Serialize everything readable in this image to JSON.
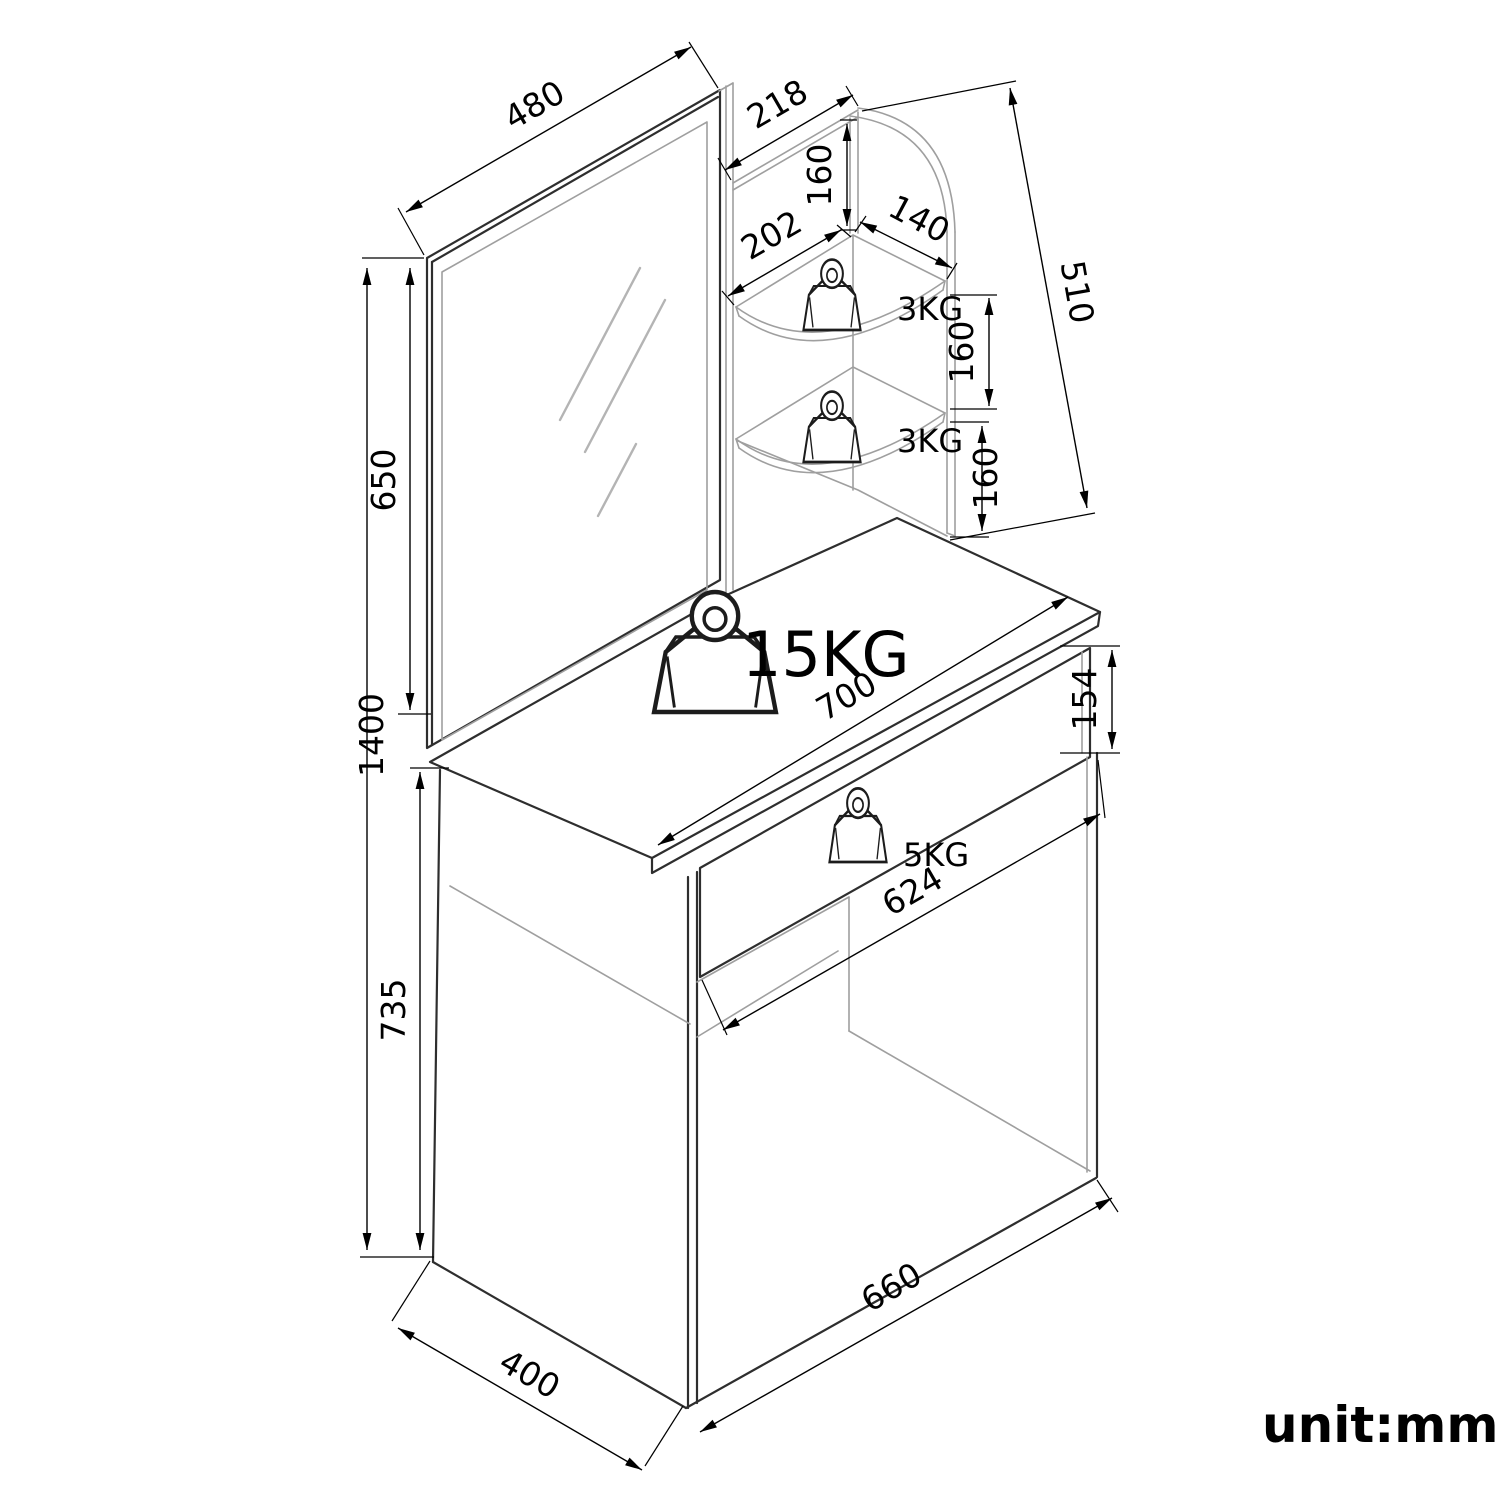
{
  "drawing": {
    "unit_label": "unit:mm",
    "capacities": {
      "tabletop": "15KG",
      "drawer": "5KG",
      "upper_shelf": "3KG",
      "lower_shelf": "3KG"
    },
    "dimensions": {
      "mirror_width": "480",
      "mirror_height": "650",
      "top_shelf_depth": "218",
      "top_shelf_gap": "160",
      "shelf_front_edge": "202",
      "shelf_side_edge": "140",
      "shelf_unit_height": "510",
      "shelf_gap_mid": "160",
      "shelf_gap_low": "160",
      "total_height": "1400",
      "tabletop_height": "735",
      "tabletop_width": "700",
      "drawer_front_height": "154",
      "drawer_width": "624",
      "base_width": "660",
      "base_depth": "400"
    },
    "colors": {
      "outline": "#2e2e2e",
      "secondary": "#9f9f9f",
      "dimension": "#000000",
      "background": "#ffffff"
    }
  }
}
